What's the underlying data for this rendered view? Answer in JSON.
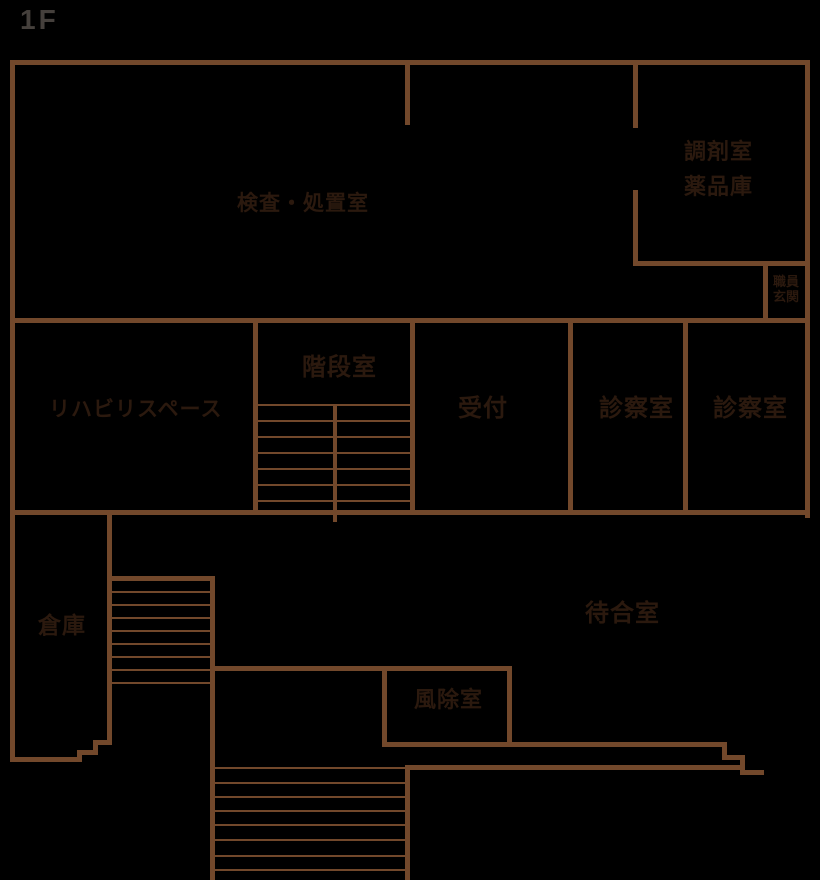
{
  "floor_label": "1F",
  "colors": {
    "background": "#000000",
    "wall": "#72482B",
    "room_label": "#2B190E",
    "floor_label_color": "#45403C"
  },
  "rooms": {
    "exam_treatment": {
      "label": "検査・処置室"
    },
    "dispensary": {
      "line1": "調剤室",
      "line2": "薬品庫"
    },
    "staff_entrance": {
      "line1": "職員",
      "line2": "玄関"
    },
    "rehab_space": {
      "label": "リハビリスペース"
    },
    "stairwell": {
      "label": "階段室"
    },
    "reception": {
      "label": "受付"
    },
    "exam_room_1": {
      "label": "診察室"
    },
    "exam_room_2": {
      "label": "診察室"
    },
    "storage": {
      "label": "倉庫"
    },
    "waiting_room": {
      "label": "待合室"
    },
    "windbreak_room": {
      "label": "風除室"
    }
  }
}
